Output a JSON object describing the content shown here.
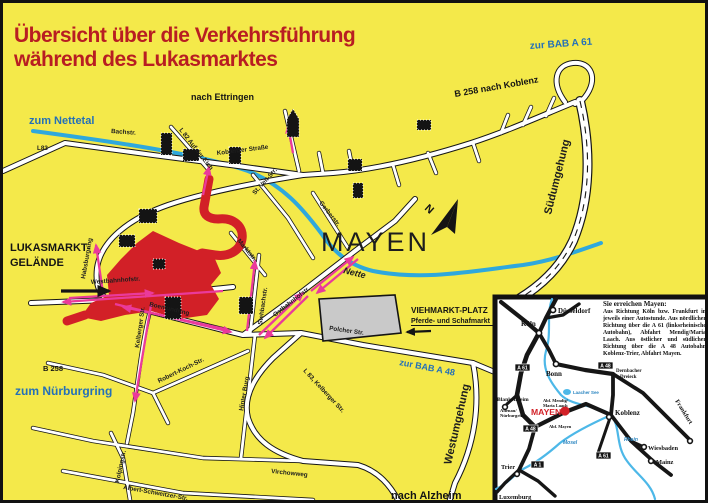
{
  "title": {
    "line1": "Übersicht über die Verkehrsführung",
    "line2": "während des Lukasmarktes"
  },
  "legend": {
    "lukasmarkt_line1": "LUKASMARKT-",
    "lukasmarkt_line2": "GELÄNDE",
    "viehmarkt_title": "VIEHMARKT-PLATZ",
    "viehmarkt_subtitle": "Pferde- und Schafmarkt"
  },
  "destinations": {
    "nettetal": "zum Nettetal",
    "bab_a61": "zur BAB A 61",
    "b258_koblenz": "B 258 nach Koblenz",
    "ettringen": "nach Ettringen",
    "b258": "B 258",
    "nuerburgring": "zum Nürburgring",
    "bab_a48": "zur BAB A 48",
    "alzheim": "nach Alzheim"
  },
  "city": {
    "name": "MAYEN",
    "river": "Nette",
    "north": "N",
    "bypass_south": "Südumgehung",
    "bypass_west": "Westumgehung"
  },
  "streets": {
    "koblenzer": "Koblenzer Straße",
    "bachstr": "Bachstr.",
    "l83": "L83",
    "auf_der_eich": "L 82 Auf der Eich",
    "st_veit": "St. Veit-Str.",
    "gerberstr": "Gerberstr.",
    "marktstr": "Marktstr.",
    "westbahnhofstr": "Westbahnhofstr.",
    "habsburgring": "Habsburgring",
    "boemundring": "Boemundring",
    "stehbachstr": "Stehbachstr.",
    "ostbahnhofstr": "Ostbahnhofstr.",
    "polcher": "Polcher Str.",
    "kelberger": "Kelberger Str.",
    "l83_kelberger": "L 83, Kelberger Str.",
    "robert_koch": "Robert-Koch-Str.",
    "hinter_burg": "Hinter Burg",
    "kolpingstr": "Kolpingstr.",
    "albert_schweitzer": "Albert-Schweitzer-Str.",
    "virchowweg": "Virchowweg"
  },
  "inset": {
    "heading": "Sie erreichen Mayen:",
    "body": "Aus Richtung Köln bzw. Frankfurt in jeweils einer Autostunde. Aus nördlicher Richtung über die A 61 (linksrheinische Autobahn), Abfahrt Mendig/Maria Laach. Aus östlicher und südlicher Richtung über die A 48 Autobahn Koblenz-Trier, Abfahrt Mayen.",
    "cities": {
      "duesseldorf": "Düsseldorf",
      "koeln": "Köln",
      "bonn": "Bonn",
      "koblenz": "Koblenz",
      "wiesbaden": "Wiesbaden",
      "mainz": "Mainz",
      "frankfurt": "Frankfurt",
      "trier": "Trier",
      "luxemburg": "Luxemburg",
      "blankenheim": "Blankenheim",
      "mayen": "MAYEN"
    },
    "labels": {
      "dernbacher_1": "Dernbacher",
      "dernbacher_2": "Dreieck",
      "adenau_1": "Adenau/",
      "adenau_2": "Nürburgring",
      "abf_mendig_1": "Abf. Mendig/",
      "abf_mendig_2": "Maria Laach",
      "abf_mayen": "Abf. Mayen",
      "laacher_see": "Laacher See",
      "mosel": "Mosel",
      "rhein": "Rhein"
    },
    "shields": {
      "a61": "A 61",
      "a48": "A 48",
      "a1": "A 1"
    }
  },
  "credit": "© STUDIO RIEGEL • G. SCHUMACHER • MAYEN",
  "colors": {
    "background": "#f4e94a",
    "road_fill": "#ffffff",
    "road_casing": "#161616",
    "market_red": "#d22027",
    "route_pink": "#ea3a9b",
    "river_blue": "#2fa8dc",
    "destination_blue": "#2470b8",
    "title_red": "#b81d22",
    "viehmarkt_gray": "#c9c9c9"
  }
}
